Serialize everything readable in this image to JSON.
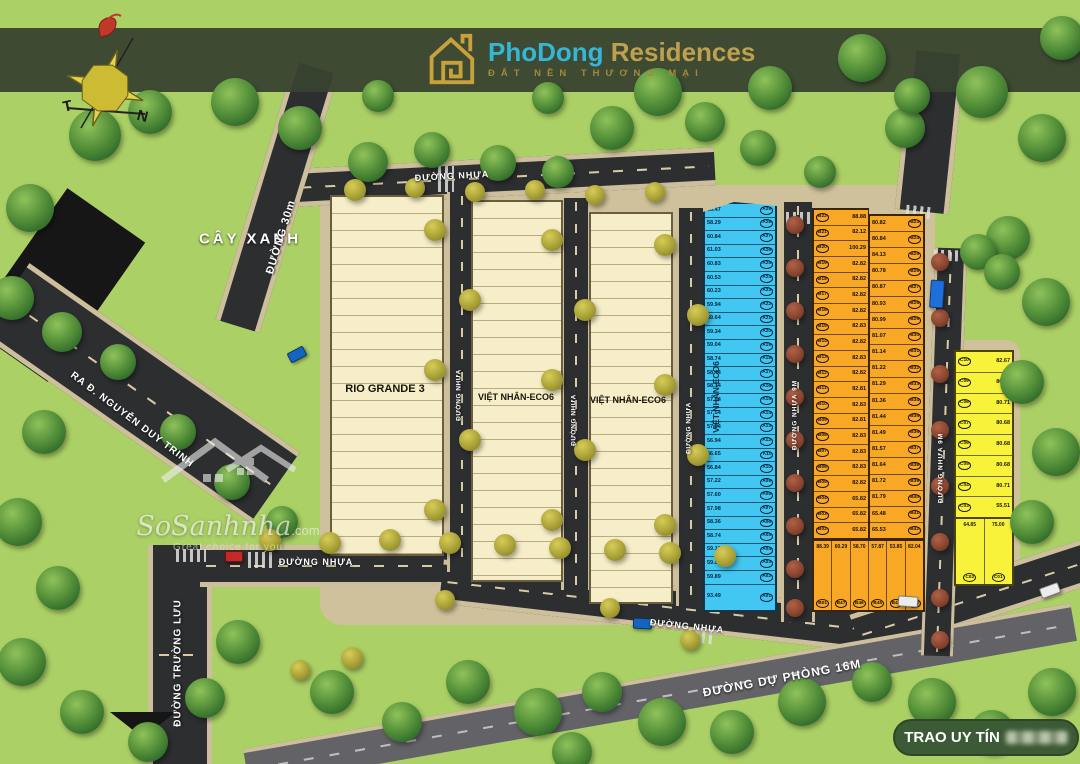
{
  "logo": {
    "brand_primary": "PhoDong",
    "brand_secondary": "Residences",
    "tagline": "ĐẤT NỀN THƯƠNG MẠI"
  },
  "compass": {
    "west_label": "T",
    "south_label": "N"
  },
  "area_labels": {
    "green_area": "CÂY XANH"
  },
  "roads": {
    "duong_30m": "ĐƯỜNG 30m",
    "exit_road": "RA Đ. NGUYỄN DUY TRINH",
    "truong_luu": "ĐƯỜNG TRƯỜNG LƯU",
    "asphalt": "ĐƯỜNG NHỰA",
    "asphalt_9m": "ĐƯỜNG NHỰA 9M",
    "reserve_16m": "ĐƯỜNG DỰ PHÒNG 16M"
  },
  "blocks": {
    "rio_grande": {
      "label": "RIO GRANDE 3"
    },
    "eco6_1": {
      "label": "VIỆT NHÂN-ECO6"
    },
    "eco6_2": {
      "label": "VIỆT NHÂN-ECO6"
    },
    "blue": {
      "label": "VIỆT NHÂN-ECO6",
      "lots": [
        {
          "id": "A29",
          "area": "63.47"
        },
        {
          "id": "A28",
          "area": "58.29"
        },
        {
          "id": "A27",
          "area": "60.84"
        },
        {
          "id": "A26",
          "area": "61.03"
        },
        {
          "id": "A25",
          "area": "60.83"
        },
        {
          "id": "A24",
          "area": "60.53"
        },
        {
          "id": "A23",
          "area": "60.23"
        },
        {
          "id": "A22",
          "area": "59.94"
        },
        {
          "id": "A21",
          "area": "59.64"
        },
        {
          "id": "A20",
          "area": "59.34"
        },
        {
          "id": "A19",
          "area": "59.04"
        },
        {
          "id": "A18",
          "area": "58.74"
        },
        {
          "id": "A17",
          "area": "58.44"
        },
        {
          "id": "A16",
          "area": "58.14"
        },
        {
          "id": "A15",
          "area": "57.84"
        },
        {
          "id": "A14",
          "area": "57.54"
        },
        {
          "id": "A13",
          "area": "57.24"
        },
        {
          "id": "A12",
          "area": "56.94"
        },
        {
          "id": "A11",
          "area": "56.65"
        },
        {
          "id": "A10",
          "area": "56.84"
        },
        {
          "id": "A09",
          "area": "57.22"
        },
        {
          "id": "A08",
          "area": "57.60"
        },
        {
          "id": "A07",
          "area": "57.98"
        },
        {
          "id": "A06",
          "area": "58.36"
        },
        {
          "id": "A05",
          "area": "58.74"
        },
        {
          "id": "A04",
          "area": "59.12"
        },
        {
          "id": "A03",
          "area": "59.51"
        },
        {
          "id": "A02",
          "area": "59.89"
        },
        {
          "id": "A01",
          "area": "93.49"
        }
      ]
    },
    "orange": {
      "left": [
        {
          "id": "B22",
          "area": "88.88"
        },
        {
          "id": "B21",
          "area": "82.12"
        },
        {
          "id": "B20",
          "area": "100.29"
        },
        {
          "id": "B19",
          "area": "82.82"
        },
        {
          "id": "B18",
          "area": "82.82"
        },
        {
          "id": "B17",
          "area": "82.82"
        },
        {
          "id": "B16",
          "area": "82.82"
        },
        {
          "id": "B15",
          "area": "82.83"
        },
        {
          "id": "B14",
          "area": "82.82"
        },
        {
          "id": "B13",
          "area": "82.83"
        },
        {
          "id": "B12",
          "area": "82.82"
        },
        {
          "id": "B11",
          "area": "82.81"
        },
        {
          "id": "B10",
          "area": "82.83"
        },
        {
          "id": "B09",
          "area": "82.81"
        },
        {
          "id": "B08",
          "area": "82.83"
        },
        {
          "id": "B07",
          "area": "82.83"
        },
        {
          "id": "B06",
          "area": "82.83"
        },
        {
          "id": "B05",
          "area": "82.82"
        },
        {
          "id": "B04",
          "area": "65.82"
        },
        {
          "id": "B03",
          "area": "65.82"
        },
        {
          "id": "B02",
          "area": "65.82"
        }
      ],
      "right": [
        {
          "id": "B23",
          "area": "80.82"
        },
        {
          "id": "B24",
          "area": "80.84"
        },
        {
          "id": "B25",
          "area": "84.13"
        },
        {
          "id": "B26",
          "area": "80.78"
        },
        {
          "id": "B27",
          "area": "80.87"
        },
        {
          "id": "B28",
          "area": "80.93"
        },
        {
          "id": "B29",
          "area": "80.99"
        },
        {
          "id": "B30",
          "area": "81.07"
        },
        {
          "id": "B31",
          "area": "81.14"
        },
        {
          "id": "B32",
          "area": "81.22"
        },
        {
          "id": "B33",
          "area": "81.29"
        },
        {
          "id": "B34",
          "area": "81.36"
        },
        {
          "id": "B35",
          "area": "81.44"
        },
        {
          "id": "B36",
          "area": "81.49"
        },
        {
          "id": "B37",
          "area": "81.57"
        },
        {
          "id": "B38",
          "area": "81.64"
        },
        {
          "id": "B39",
          "area": "81.72"
        },
        {
          "id": "B40",
          "area": "81.79"
        },
        {
          "id": "B41",
          "area": "65.48"
        },
        {
          "id": "B42",
          "area": "65.53"
        }
      ],
      "bottom": [
        {
          "id": "B01",
          "area": "88.39"
        },
        {
          "id": "B47",
          "area": "60.29"
        },
        {
          "id": "B46",
          "area": "58.70"
        },
        {
          "id": "B45",
          "area": "57.87"
        },
        {
          "id": "B44",
          "area": "53.85"
        },
        {
          "id": "B43",
          "area": "82.04"
        }
      ]
    },
    "yellow": {
      "rows": [
        {
          "id": "C10",
          "area": "82.67"
        },
        {
          "id": "C09",
          "area": "80.72"
        },
        {
          "id": "C08",
          "area": "80.71"
        },
        {
          "id": "C07",
          "area": "80.68"
        },
        {
          "id": "C06",
          "area": "80.68"
        },
        {
          "id": "C05",
          "area": "80.68"
        },
        {
          "id": "C04",
          "area": "80.71"
        },
        {
          "id": "C03",
          "area": "55.51"
        }
      ],
      "bottom": [
        {
          "id": "C02",
          "area": "64.85"
        },
        {
          "id": "C01",
          "area": "75.00"
        }
      ]
    }
  },
  "watermark": {
    "name": "SoSanhnha",
    "suffix": ".com",
    "tagline": "Great choice for you"
  },
  "banner": {
    "visible_text": "TRAO UY TÍN"
  }
}
